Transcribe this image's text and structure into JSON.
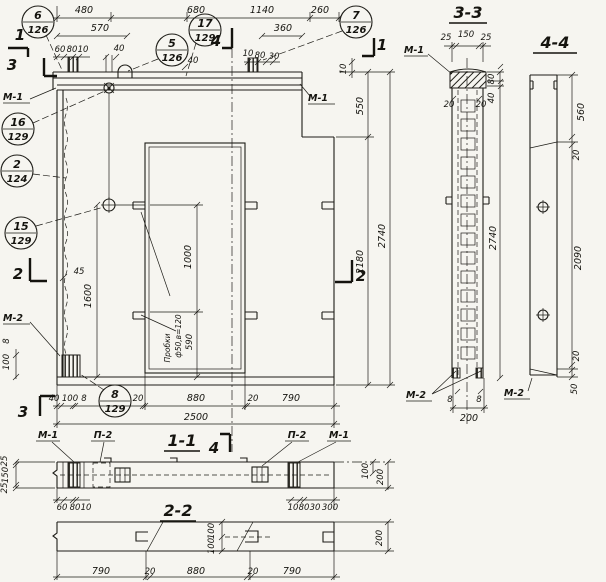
{
  "drawing": {
    "callouts": {
      "c6": {
        "num": "6",
        "sheet": "126"
      },
      "c17": {
        "num": "17",
        "sheet": "129"
      },
      "c7": {
        "num": "7",
        "sheet": "126"
      },
      "c5": {
        "num": "5",
        "sheet": "126"
      },
      "c16": {
        "num": "16",
        "sheet": "129"
      },
      "c2": {
        "num": "2",
        "sheet": "124"
      },
      "c15": {
        "num": "15",
        "sheet": "129"
      },
      "c8": {
        "num": "8",
        "sheet": "129"
      }
    },
    "section_titles": {
      "s11": "1-1",
      "s22": "2-2",
      "s33": "3-3",
      "s44": "4-4"
    },
    "cuts": {
      "one": "1",
      "two": "2",
      "three": "3",
      "four": "4"
    },
    "marks": {
      "m1": "М-1",
      "m2": "М-2",
      "p2": "П-2"
    },
    "front": {
      "top": {
        "d480": "480",
        "d680": "680",
        "d1140": "1140",
        "d260": "260",
        "d570": "570",
        "d360": "360",
        "d60": "60",
        "d80": "80",
        "d10": "10",
        "d40a": "40",
        "d40b": "40",
        "d10r": "10",
        "d80r": "80",
        "d30r": "30",
        "d10v": "10"
      },
      "right": {
        "d550": "550",
        "d2180": "2180",
        "d2740": "2740"
      },
      "left": {
        "d45": "45",
        "d1600": "1600",
        "v8": "8",
        "v100": "100"
      },
      "bottom": {
        "d40": "40",
        "d100": "100",
        "d8": "8",
        "d20a": "20",
        "d880": "880",
        "d20b": "20",
        "d790": "790",
        "d2500": "2500"
      },
      "opening": {
        "d1000": "1000",
        "d590": "590",
        "note1": "Пробки",
        "note2": "ф50,в=120"
      }
    },
    "s33": {
      "d25a": "25",
      "d150": "150",
      "d25b": "25",
      "d80": "80",
      "d40": "40",
      "d20a": "20",
      "d20b": "20",
      "d2740": "2740",
      "d8a": "8",
      "d8b": "8",
      "d200": "200"
    },
    "s44": {
      "d560": "560",
      "d20a": "20",
      "d2090": "2090",
      "d20b": "20",
      "d50": "50"
    },
    "s11": {
      "d25a": "25",
      "d150": "150",
      "d25b": "25",
      "d60": "60",
      "d80l": "80",
      "d10l": "10",
      "d10r": "10",
      "d80r": "80",
      "d30": "30",
      "d300": "300",
      "d100": "100",
      "d200": "200"
    },
    "s22": {
      "d790a": "790",
      "d20a": "20",
      "d880": "880",
      "d20b": "20",
      "d790b": "790",
      "d100a": "100",
      "d100b": "100",
      "d200": "200"
    }
  }
}
